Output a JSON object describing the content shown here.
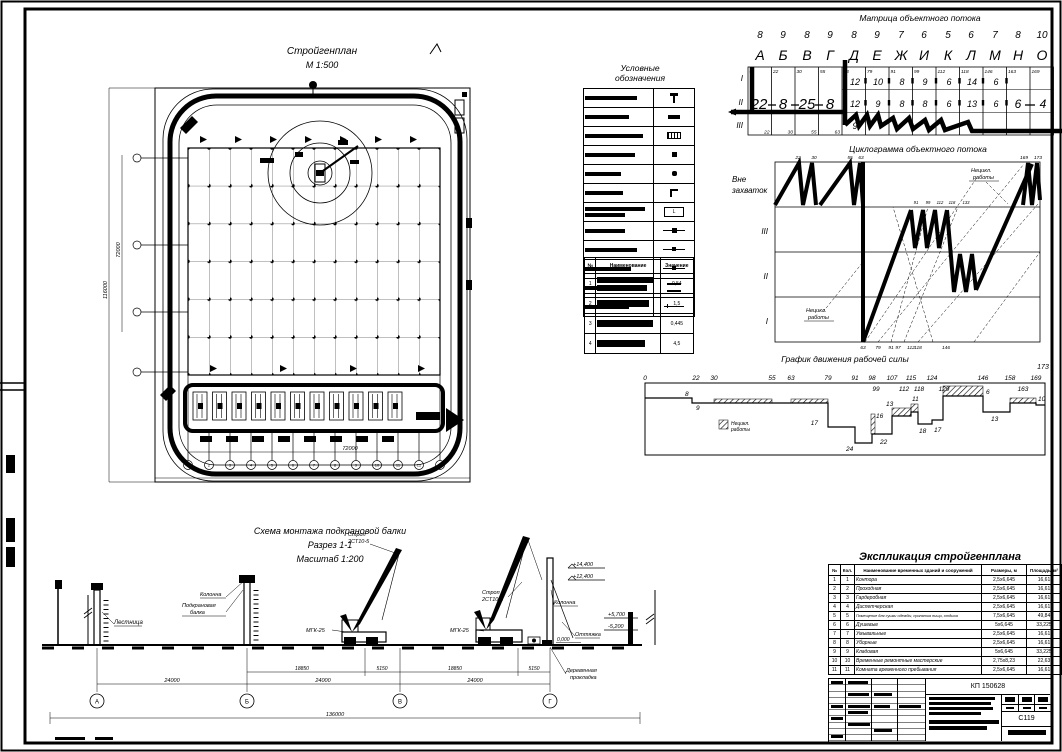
{
  "site_plan": {
    "title": "Стройгенплан",
    "scale": "М 1:500",
    "dims": {
      "bottom_inner": "72000",
      "bottom_total": "118000",
      "left_inner": "72000",
      "left_total": "116000"
    },
    "axes": [
      "1",
      "2",
      "3",
      "4",
      "5",
      "6",
      "7",
      "8",
      "9",
      "10",
      "11",
      "12",
      "13"
    ]
  },
  "legend": {
    "title1": "Условные",
    "title2": "обозначения"
  },
  "params_table": {
    "headers": [
      "№",
      "Наименование",
      "Значение"
    ],
    "rows": [
      {
        "n": "1",
        "v": "0,54"
      },
      {
        "n": "2",
        "v": "1,5"
      },
      {
        "n": "3",
        "v": "0,445"
      },
      {
        "n": "4",
        "v": "4,5"
      }
    ]
  },
  "matrix": {
    "title": "Матрица объектного потока",
    "durations": [
      "8",
      "9",
      "8",
      "9",
      "8",
      "9",
      "7",
      "6",
      "5",
      "6",
      "7",
      "8",
      "10"
    ],
    "letters": [
      "А",
      "Б",
      "В",
      "Г",
      "Д",
      "Е",
      "Ж",
      "И",
      "К",
      "Л",
      "М",
      "Н",
      "О"
    ],
    "row_labels": [
      "I",
      "II",
      "III"
    ],
    "big": [
      "22",
      "8",
      "25",
      "8"
    ],
    "row1": [
      "12",
      "10",
      "8",
      "9",
      "6",
      "14",
      "6"
    ],
    "row2": [
      "12",
      "9",
      "8",
      "8",
      "6",
      "13",
      "6"
    ],
    "row3_first": "9",
    "tail": [
      "6",
      "4"
    ],
    "corners_top": [
      "0",
      "22",
      "30",
      "55",
      "63",
      "79",
      "91",
      "99",
      "112",
      "118",
      "146",
      "163",
      "169"
    ],
    "corners_bottom": [
      "22",
      "30",
      "55",
      "63"
    ]
  },
  "cyclogram": {
    "title": "Циклограмма объектного потока",
    "left1": "Вне",
    "left2": "захваток",
    "bands": [
      "III",
      "II",
      "I"
    ],
    "note1": "Нецикл.",
    "note2": "работы",
    "axis": [
      "63",
      "79",
      "91",
      "97",
      "112",
      "118",
      "146"
    ],
    "top_ticks": [
      "22",
      "30",
      "55",
      "63",
      "169",
      "173"
    ],
    "mid_ticks": [
      "91",
      "99",
      "112",
      "118",
      "133"
    ]
  },
  "labor_chart": {
    "type": "line",
    "title": "График движения рабочей силы",
    "end_tick": "173",
    "x1": [
      "0",
      "22",
      "30",
      "55",
      "63",
      "79",
      "91",
      "98",
      "107",
      "115",
      "124",
      "146",
      "158",
      "169"
    ],
    "x2": [
      "99",
      "112",
      "118",
      "129",
      "163"
    ],
    "values": [
      "8",
      "9",
      "17",
      "24",
      "16",
      "22",
      "13",
      "11",
      "18",
      "17",
      "6",
      "13",
      "10"
    ],
    "legend1": "Нецикл.",
    "legend2": "работы"
  },
  "section": {
    "title": "Схема монтажа подкрановой балки",
    "subtitle": "Разрез 1-1",
    "scale": "Масштаб 1:200",
    "labels": {
      "ladder": "Лестница",
      "column1": "Колонна",
      "beam1": "Подкрановая",
      "beam2": "балка",
      "sling1": "Строп",
      "sling2": "2СТ10-5",
      "crane": "МГК-25",
      "column2": "Колонна",
      "guy": "Оттяжка",
      "pad1": "Деревянная",
      "pad2": "прокладка"
    },
    "elevations": {
      "e1": "+14,400",
      "e2": "+12,400",
      "e3": "+5,700",
      "e4": "-5,200",
      "zero": "0,000"
    },
    "dims": {
      "sub1": "18850",
      "sub2": "5150",
      "main": "24000",
      "total": "136000"
    },
    "axes": [
      "А",
      "Б",
      "В",
      "Г"
    ]
  },
  "explication": {
    "title": "Экспликация стройгенплана",
    "headers": [
      "№",
      "Кол.",
      "Наименование временных зданий и сооружений",
      "Размеры, м",
      "Площадь, м²"
    ],
    "rows": [
      {
        "n": "1",
        "q": "1",
        "name": "Контора",
        "size": "2,5х6,645",
        "area": "16,61"
      },
      {
        "n": "2",
        "q": "2",
        "name": "Проходная",
        "size": "2,5х6,645",
        "area": "16,61"
      },
      {
        "n": "3",
        "q": "3",
        "name": "Гардеробная",
        "size": "2,5х6,645",
        "area": "16,61"
      },
      {
        "n": "4",
        "q": "4",
        "name": "Диспетчерская",
        "size": "2,5х6,645",
        "area": "16,61"
      },
      {
        "n": "5",
        "q": "5",
        "name": "Помещение для сушки одежды, принятия пищи, отдыха",
        "size": "7,5х6,645",
        "area": "49,84"
      },
      {
        "n": "6",
        "q": "6",
        "name": "Душевые",
        "size": "5х6,645",
        "area": "33,225"
      },
      {
        "n": "7",
        "q": "7",
        "name": "Умывальные",
        "size": "2,5х6,645",
        "area": "16,61"
      },
      {
        "n": "8",
        "q": "8",
        "name": "Уборные",
        "size": "2,5х6,645",
        "area": "16,61"
      },
      {
        "n": "9",
        "q": "9",
        "name": "Кладовая",
        "size": "5х6,645",
        "area": "33,225"
      },
      {
        "n": "10",
        "q": "10",
        "name": "Временные ремонтные мастерские",
        "size": "2,75х8,23",
        "area": "22,63"
      },
      {
        "n": "11",
        "q": "11",
        "name": "Комната временного пребывания",
        "size": "2,5х6,645",
        "area": "16,61"
      }
    ]
  },
  "title_block": {
    "code": "КП 150628",
    "sheet": "С119"
  }
}
